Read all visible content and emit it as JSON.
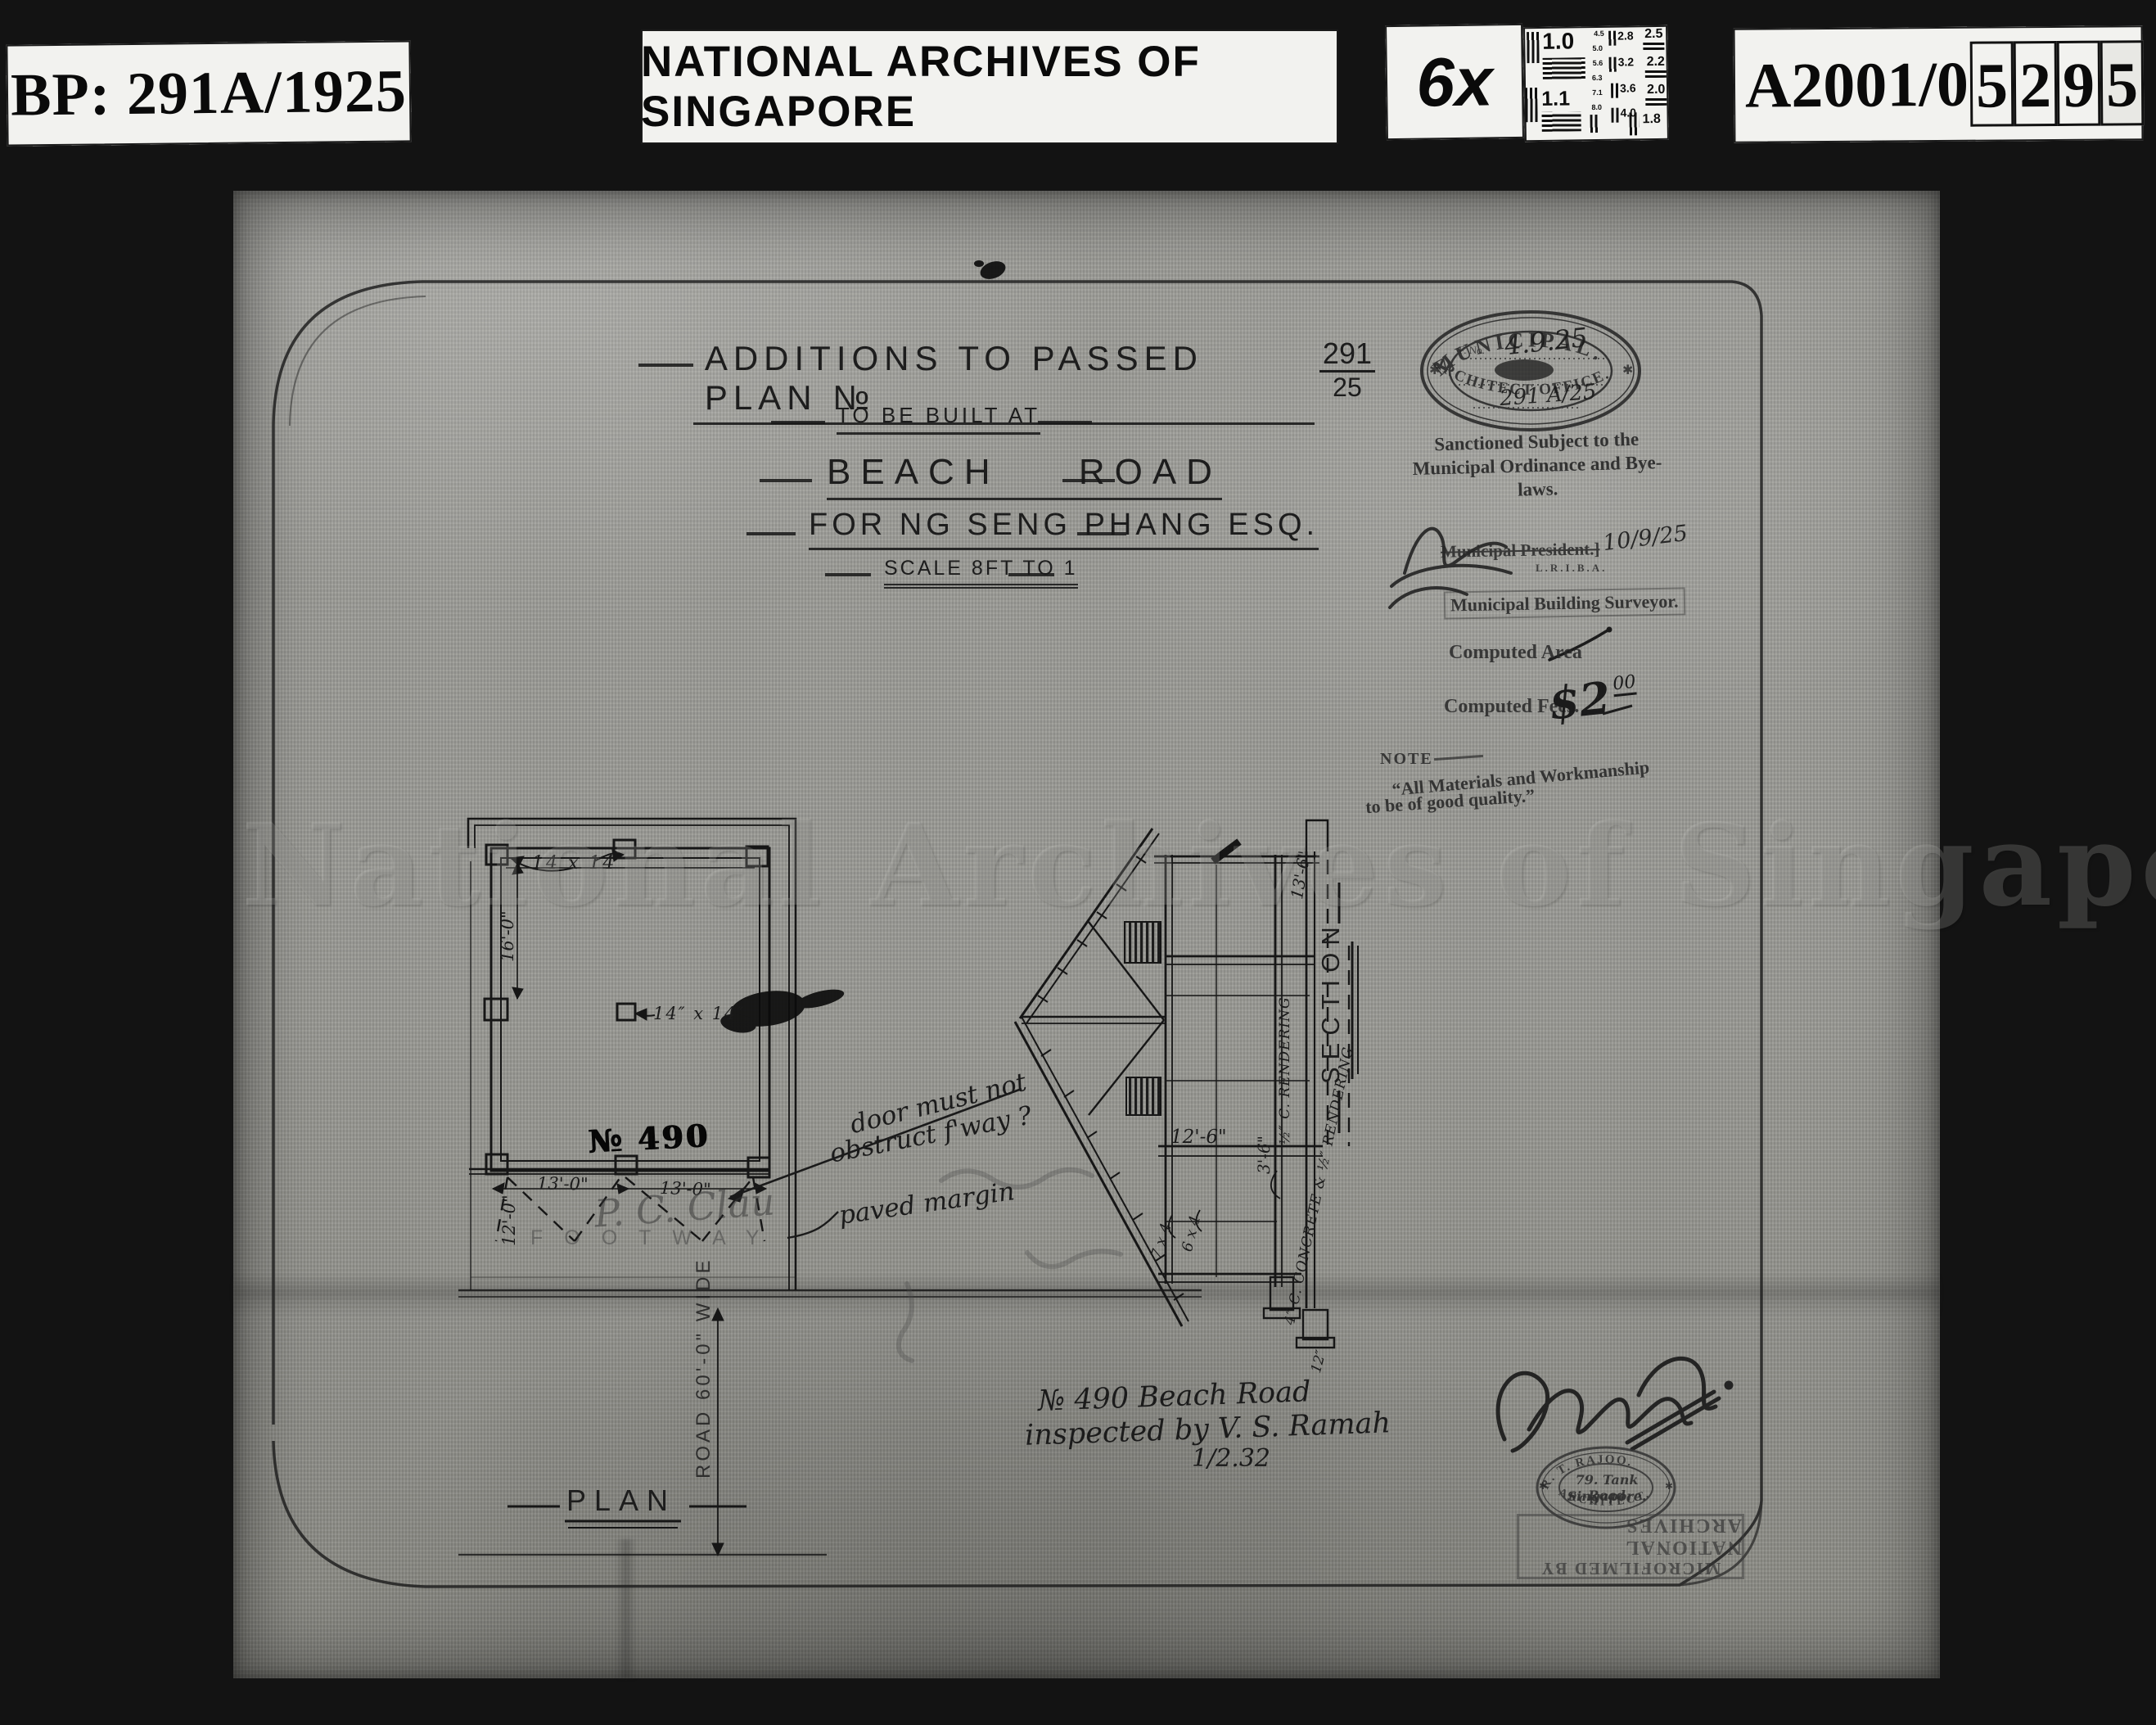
{
  "header": {
    "bp_label": "BP: 291A/1925",
    "archives_label": "NATIONAL ARCHIVES OF SINGAPORE",
    "magnification": "6x",
    "accession_prefix": "A2001/0",
    "accession_digits": [
      "5",
      "2",
      "9",
      "5"
    ],
    "test_chart": {
      "big": [
        "1.0",
        "1.1"
      ],
      "small_col": [
        "4.5",
        "5.0",
        "5.6",
        "6.3",
        "7.1",
        "8.0"
      ],
      "mid_col": [
        "2.8",
        "3.2",
        "3.6",
        "4.0"
      ],
      "right_col": [
        "2.5",
        "2.2",
        "2.0",
        "1.8"
      ]
    }
  },
  "title_block": {
    "line1": "Additions To Passed Plan №",
    "plan_no_top": "291",
    "plan_no_bottom": "25",
    "line2": "To Be Built At",
    "line3": "Beach Road",
    "line4": "For Ng Seng Phang Esq.",
    "line5": "Scale 8ft to 1"
  },
  "municipal_stamp": {
    "arc_top": "MUNICIPAL.",
    "arc_bottom": "ARCHITECT OFFICE.",
    "star_left": "✱",
    "star_right": "✱",
    "field1": "F. No.",
    "date_script": "4.9.25",
    "plan_ref": "291 A/25"
  },
  "sanction": {
    "line1": "Sanctioned Subject to the",
    "line2": "Municipal Ordinance and Bye-laws."
  },
  "approval": {
    "president_stamp": "Municipal President.]",
    "date": "10/9/25",
    "qualifications": "L.R.I.B.A.",
    "surveyor_stamp": "Municipal Building Surveyor.",
    "computed_area_label": "Computed Area",
    "computed_fees_label": "Computed Fees.",
    "fees_value": "$2",
    "fees_cents": "00"
  },
  "note": {
    "label": "NOTE",
    "line1": "“All Materials and Workmanship",
    "line2": "to be of good quality.”"
  },
  "watermark": "National Archives of Singapore",
  "plan": {
    "label": "PLAN",
    "post_label_top": "14 x 14",
    "post_label_center": "14″ x 14″",
    "dim_16": "16'-0\"",
    "dim_13a": "13'-0\"",
    "dim_13b": "13'-0\"",
    "dim_12": "12'-0\"",
    "house_no": "№ 490",
    "pencil_note": "P. C. Clau",
    "footway": "FOOTWAY",
    "road": "ROAD 60'-0\" WIDE"
  },
  "annotations": {
    "n1": "door must not",
    "n2": "obstruct f'way ?",
    "n3": "paved margin"
  },
  "section": {
    "label": "SECTION",
    "dim_12_6": "12'-6\"",
    "dim_13_6": "13'-6\"",
    "dim_3_6": "3'-6\"",
    "rendering": "½″ C. RENDERING",
    "concrete": "4″ C. CONCRETE & ½″ RENDERING",
    "member_7x4": "7 x 4",
    "member_6x4": "6 x 4",
    "footing_12": "12″"
  },
  "inspection": {
    "line1": "№ 490 Beach Road",
    "line2": "inspected by V. S. Ramah",
    "line3": "1/2.32"
  },
  "architect_stamp": {
    "arc_top": "R. T. RAJOO.",
    "line1": "79. Tank Road",
    "line2": "Singapore.",
    "arc_bottom": "ARCHITECT.",
    "star_left": "✱",
    "star_right": "✱"
  },
  "microfilm_stamp": {
    "line1": "MICROFILMED BY",
    "line2": "NATIONAL ARCHIVES"
  }
}
